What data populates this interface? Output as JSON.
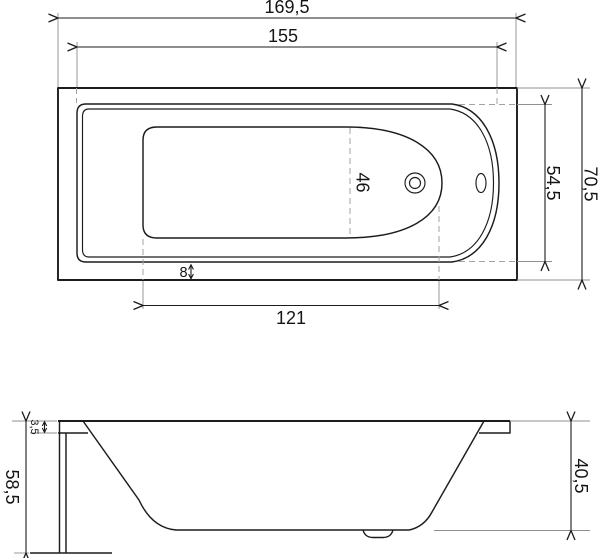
{
  "palette": {
    "ink": "#1c1c1c",
    "extension_gray": "#8f8f8f",
    "dashed_gray": "#a3a3a3",
    "background": "#ffffff"
  },
  "top_view": {
    "length_overall": "169,5",
    "length_rim": "155",
    "length_bottom": "121",
    "width_interior": "46",
    "apron_offset": "8",
    "width_rim": "54,5",
    "width_overall": "70,5"
  },
  "side_view": {
    "rim_thickness": "3,5",
    "height_overall": "58,5",
    "depth_interior": "40,5"
  }
}
